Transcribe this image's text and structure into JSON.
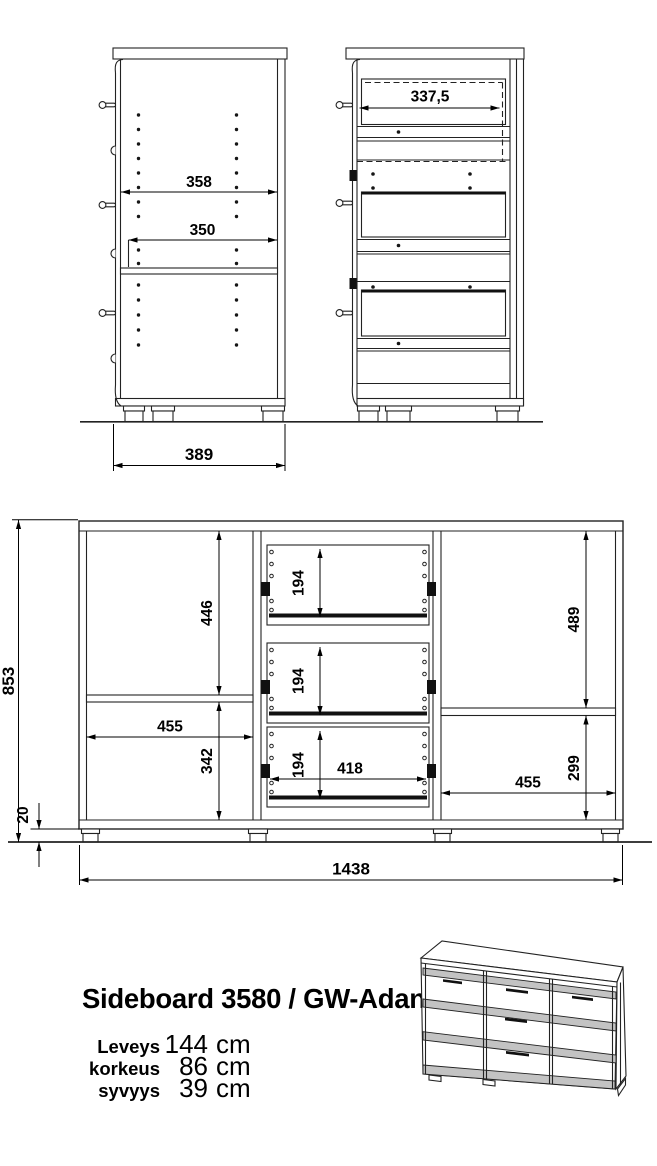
{
  "product": {
    "title": "Sideboard 3580 / GW-Adana",
    "specs": [
      {
        "label": "Leveys",
        "num": "144",
        "unit": "cm"
      },
      {
        "label": "korkeus",
        "num": "86",
        "unit": "cm"
      },
      {
        "label": "syvyys",
        "num": "39",
        "unit": "cm"
      }
    ]
  },
  "side_view_left": {
    "dim_inner_width_upper": "358",
    "dim_inner_width_lower": "350",
    "dim_depth_total": "389"
  },
  "side_view_right": {
    "dim_drawer_depth": "337,5"
  },
  "front_view": {
    "dim_total_height": "853",
    "dim_plinth_height": "20",
    "dim_left_upper": "446",
    "dim_left_width": "455",
    "dim_left_lower": "342",
    "dim_drawer_opening": "194",
    "dim_drawer_width": "418",
    "dim_right_upper": "489",
    "dim_right_lower": "299",
    "dim_right_width": "455",
    "dim_total_width": "1438"
  }
}
